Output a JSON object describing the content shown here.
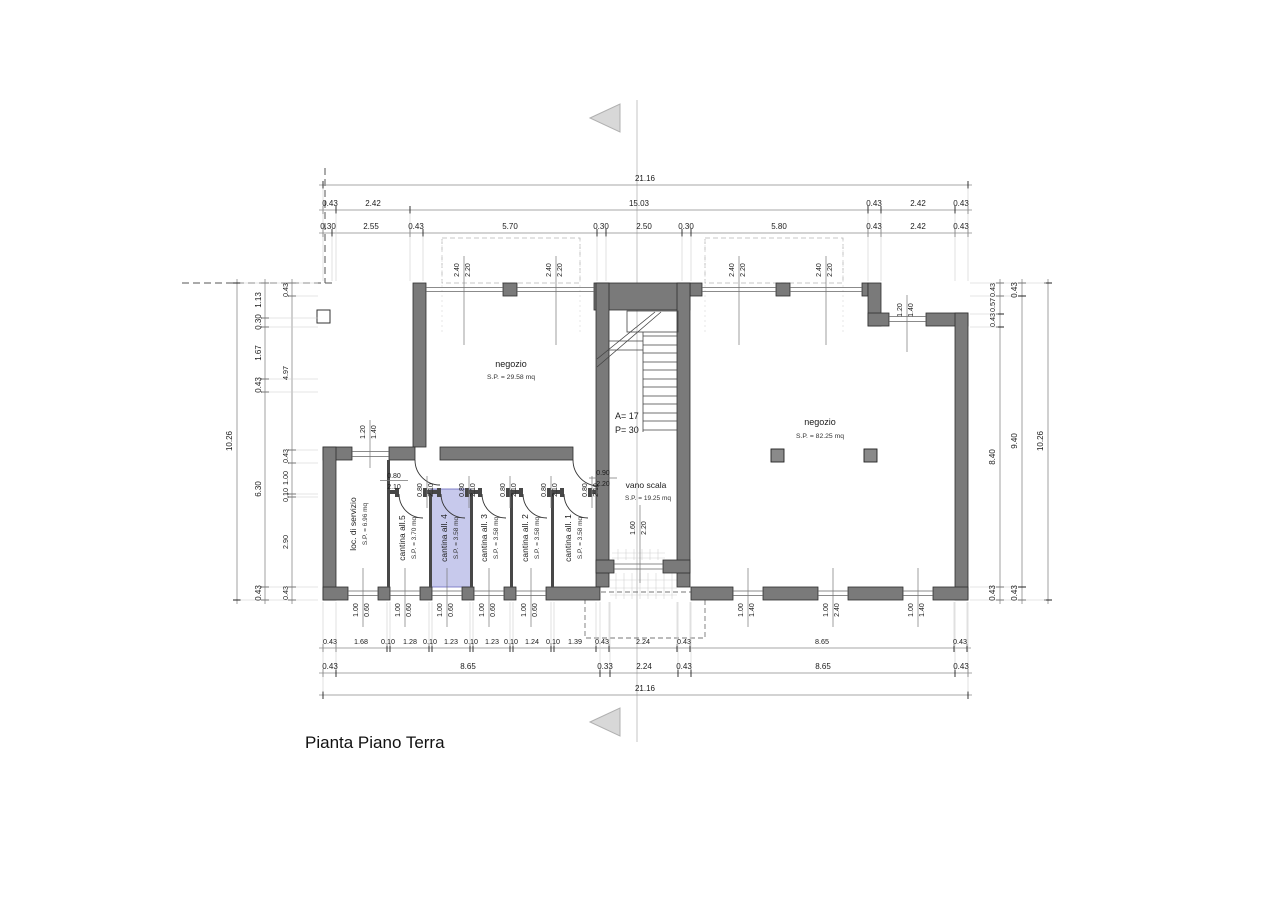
{
  "title": "Pianta Piano Terra",
  "dims": {
    "top": {
      "total": "21.16",
      "row2": [
        "0.43",
        "2.42",
        "15.03",
        "0.43",
        "2.42",
        "0.43"
      ],
      "row3": [
        "0.30",
        "2.55",
        "0.43",
        "5.70",
        "0.30",
        "2.50",
        "0.30",
        "5.80",
        "0.43",
        "2.42",
        "0.43"
      ]
    },
    "bottom": {
      "row1": [
        "0.43",
        "1.68",
        "0.10",
        "1.28",
        "0.10",
        "1.23",
        "0.10",
        "1.23",
        "0.10",
        "1.24",
        "0.10",
        "1.39",
        "0.43",
        "2.24",
        "0.43",
        "8.65",
        "0.43"
      ],
      "row2": [
        "0.43",
        "8.65",
        "0.33",
        "2.24",
        "0.43",
        "8.65",
        "0.43"
      ],
      "total": "21.16"
    },
    "left": {
      "total": "10.26",
      "outer": [
        "1.13",
        "0.30",
        "1.67",
        "0.43",
        "6.30",
        "0.43"
      ],
      "inner": [
        "0.43",
        "4.97",
        "0.43",
        "1.00",
        "0.10",
        "2.90",
        "0.43"
      ]
    },
    "right": {
      "total": "10.26",
      "inner": [
        "0.43",
        "0.57",
        "0.43",
        "8.40",
        "0.43"
      ],
      "mid": [
        "0.43",
        "9.40",
        "0.43"
      ]
    }
  },
  "rooms": {
    "negozio_sx": {
      "name": "negozio",
      "area": "S.P. = 29.58 mq"
    },
    "negozio_dx": {
      "name": "negozio",
      "area": "S.P. = 82.25 mq"
    },
    "vano_scala": {
      "name": "vano scala",
      "area": "S.P. = 19.25 mq"
    },
    "loc_servizio": {
      "name": "loc. di servizio",
      "area": "S.P. = 6.96 mq"
    },
    "cantina_5": {
      "name": "cantina all.5",
      "area": "S.P. = 3.70 mq"
    },
    "cantina_4": {
      "name": "cantina all. 4",
      "area": "S.P. = 3.58 mq"
    },
    "cantina_3": {
      "name": "cantina all. 3",
      "area": "S.P. = 3.58 mq"
    },
    "cantina_2": {
      "name": "cantina all. 2",
      "area": "S.P. = 3.58 mq"
    },
    "cantina_1": {
      "name": "cantina all. 1",
      "area": "S.P. = 3.58 mq"
    }
  },
  "stair": {
    "risers": "A= 17",
    "tread": "P= 30"
  },
  "openings": {
    "storefront": {
      "w": "2.40",
      "h": "2.20"
    },
    "window_small": {
      "w": "1.20",
      "h": "1.40"
    },
    "door_cantina": {
      "w": "0.80",
      "h": "2.10"
    },
    "door_vano": {
      "w": "0.90",
      "h": "2.20"
    },
    "entry": {
      "w": "1.60",
      "h": "2.20"
    },
    "window_low": {
      "w": "1.00",
      "h": "0.60"
    },
    "window_dx_small": {
      "w": "1.00",
      "h": "1.40"
    },
    "window_dx_tall": {
      "w": "1.00",
      "h": "2.40"
    }
  },
  "colors": {
    "wall": "#7a7a7a",
    "highlight": "#c7c9ec",
    "section_marker": "#d8d8d8"
  }
}
